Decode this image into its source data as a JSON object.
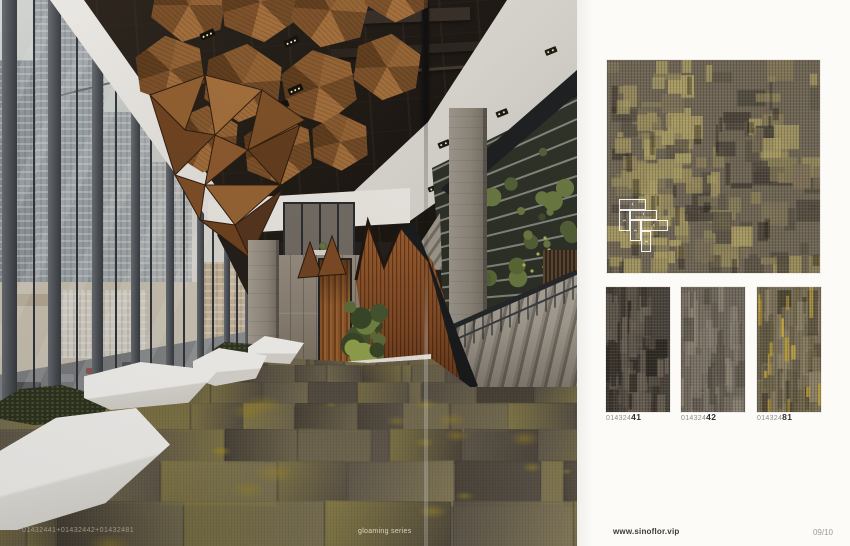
{
  "photo": {
    "code_overlay": "01432441+01432442+01432481",
    "series_label": "gloaming series"
  },
  "catalog": {
    "products": [
      {
        "code_prefix": "014324",
        "code_suffix": "41"
      },
      {
        "code_prefix": "014324",
        "code_suffix": "42"
      },
      {
        "code_prefix": "014324",
        "code_suffix": "81"
      }
    ],
    "website": "www.sinoflor.vip",
    "page_number": "09/10",
    "install_diagram": {
      "tile_dirs": [
        "left",
        "left",
        "up",
        "left",
        "up",
        "up"
      ]
    }
  },
  "glyphs": {
    "chevron": "‹"
  },
  "colors": {
    "page_bg": "#fcfbf8",
    "copper": "#8a5a2e",
    "carpet_base": "#6e6557",
    "accent_yellow": "#bfa63e",
    "carpet_palette": [
      "#746b5c",
      "#675f52",
      "#544d41",
      "#8d8263",
      "#9c9169",
      "#a79a58"
    ],
    "big_swatch_bg": "#6f6554",
    "big_swatch_palette": [
      "#a89b63",
      "#998c5c",
      "#887d58",
      "#5d5546",
      "#4b443a",
      "#7c7158"
    ],
    "swatch1_bg": "#4a433c",
    "swatch1_palette": [
      "#5c5449",
      "#3a342d",
      "#6a6154",
      "#2f2a24"
    ],
    "swatch2_bg": "#6f675b",
    "swatch2_palette": [
      "#7d7568",
      "#5f584d",
      "#898071",
      "#554e44"
    ],
    "swatch3_bg": "#7a7058",
    "swatch3_palette": [
      "#5f5641",
      "#8c8166",
      "#6d6349",
      "#4e4635"
    ],
    "swatch3_yellow": [
      "#c7a93c",
      "#b89a34"
    ]
  }
}
